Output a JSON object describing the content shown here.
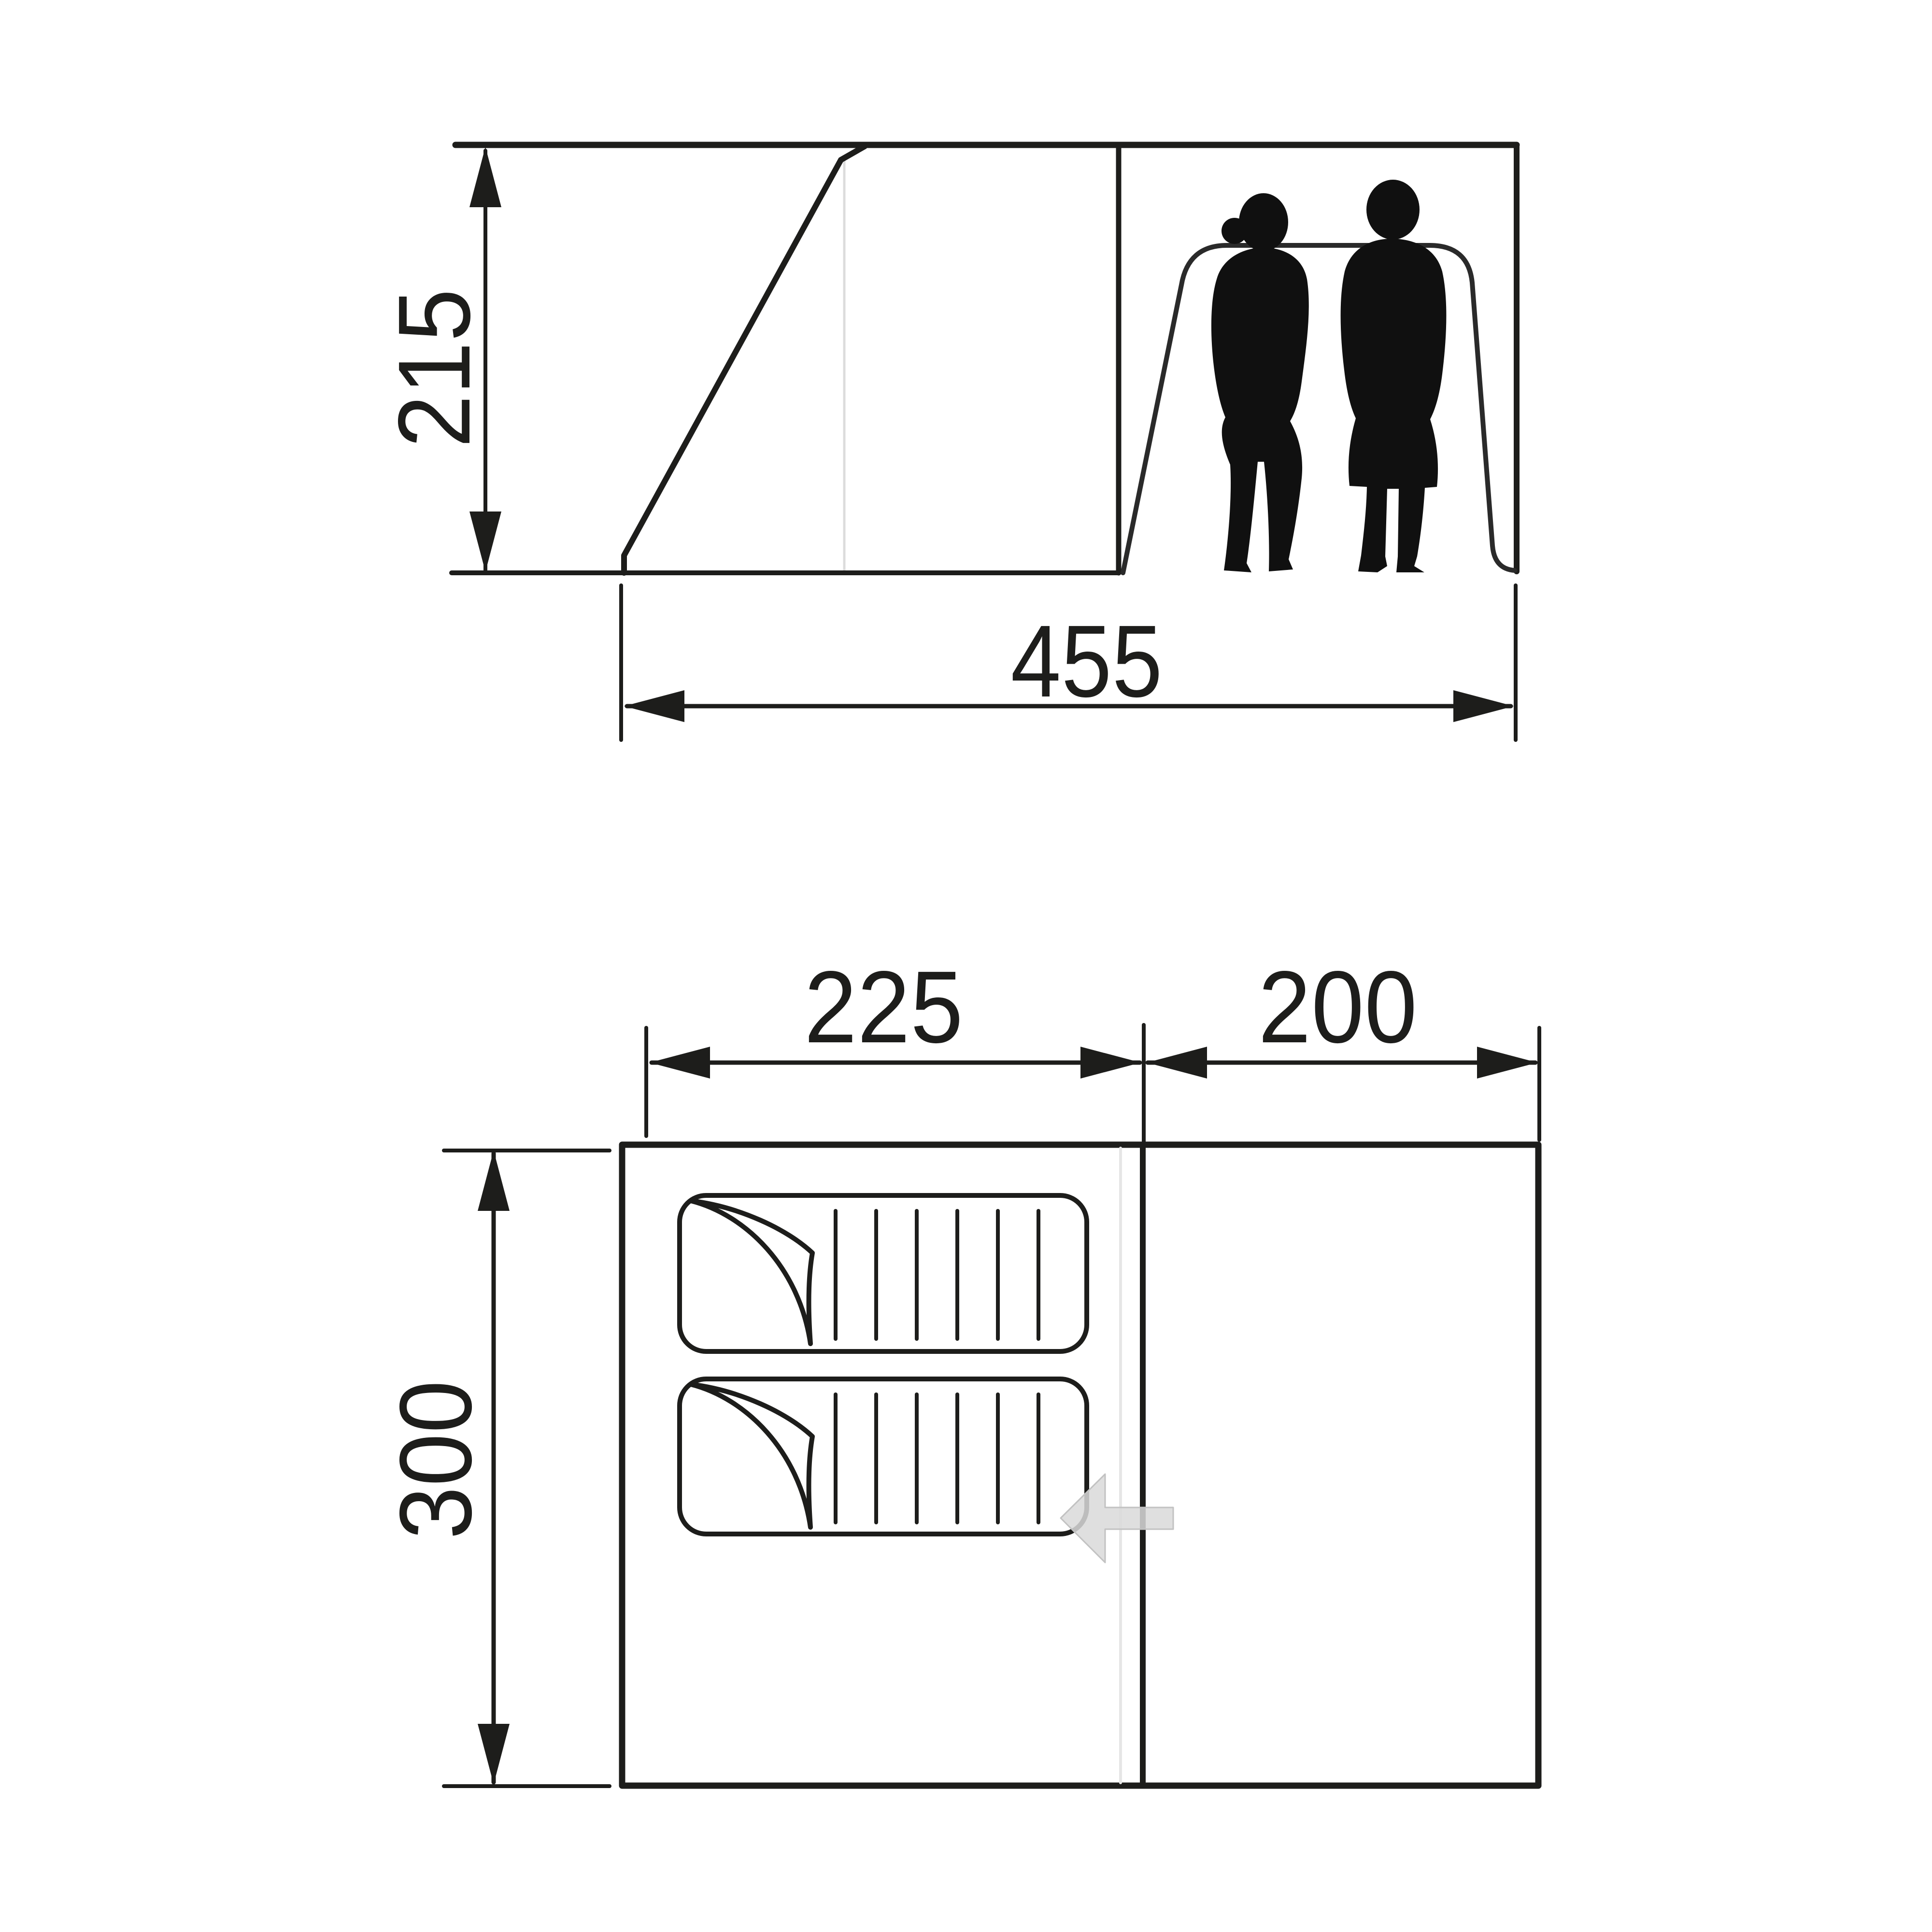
{
  "side_view": {
    "height_label": "215",
    "width_label": "455",
    "occupants_icon": "two-person-silhouette"
  },
  "floor_plan": {
    "sleeping_area_width_label": "225",
    "living_area_width_label": "200",
    "depth_label": "300",
    "sleeping_mats_count": 2,
    "entrance_icon": "left-arrow"
  },
  "colors": {
    "line": "#1d1d1b",
    "arch_line": "#2a2a2a",
    "faint_line": "#dcdcdc",
    "seam_line": "#e6e6e6",
    "entrance_arrow_fill": "#d9d9d9",
    "silhouette": "#101010",
    "background": "#ffffff"
  }
}
